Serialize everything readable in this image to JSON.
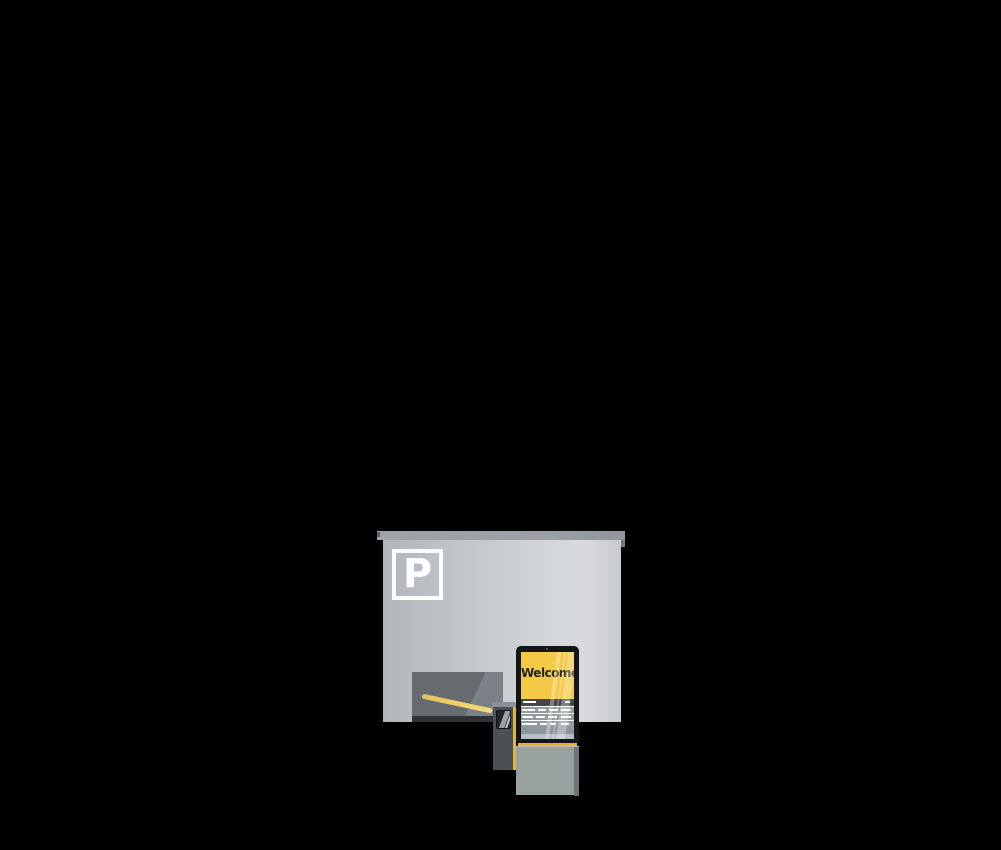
{
  "scene": {
    "description": "Flat vector illustration of a parking garage entrance with barrier gate and welcome kiosk on a black background",
    "background_color": "#000000"
  },
  "building": {
    "parking_sign_letter": "P",
    "colors": {
      "roof": "#9aa0a5",
      "facade_left": "#b1b6ba",
      "facade_right": "#d8dbde",
      "opening": "#666b70",
      "opening_highlight": "#7b8186",
      "opening_shadow": "#2f3337",
      "sign": "#ffffff"
    }
  },
  "barrier": {
    "colors": {
      "arm": "#eccf6b",
      "post_body": "#4a5056",
      "post_cap": "#8a9196",
      "edge_stripe": "#e0b734",
      "display": "#23262a"
    }
  },
  "kiosk": {
    "welcome_text": "Welcome",
    "colors": {
      "bezel": "#141517",
      "screen_yellow": "#f3c945",
      "welcome_text": "#232321",
      "list_header": "#42474c",
      "list_rows": "#949ba0",
      "bottom_band": "#b7bdc1",
      "trim_stripe": "#e4b52e",
      "pedestal": "#97a19f",
      "pedestal_edge": "#6d7578"
    }
  }
}
